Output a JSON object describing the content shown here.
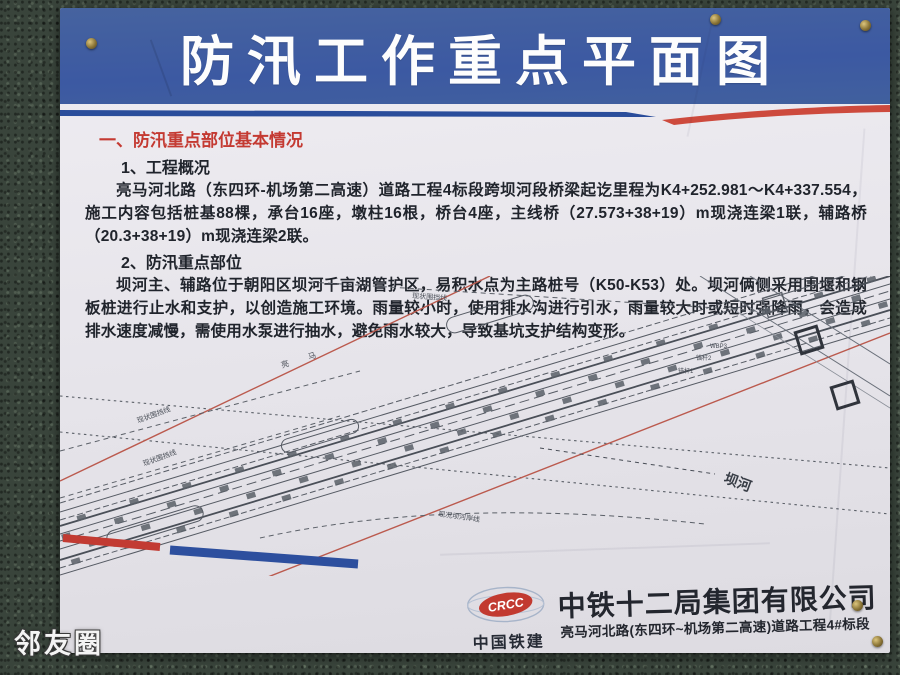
{
  "watermark": "邻友圈",
  "poster": {
    "title": "防汛工作重点平面图",
    "section": {
      "heading": "一、防汛重点部位基本情况",
      "sub1": "1、工程概况",
      "para1": "亮马河北路（东四环-机场第二高速）道路工程4标段跨坝河段桥梁起讫里程为K4+252.981～K4+337.554，施工内容包括桩基88棵，承台16座，墩柱16根，桥台4座，主线桥（27.573+38+19）m现浇连梁1联，辅路桥（20.3+38+19）m现浇连梁2联。",
      "sub2": "2、防汛重点部位",
      "para2": "坝河主、辅路位于朝阳区坝河千亩湖管护区，易积水点为主路桩号（K50-K53）处。坝河俩侧采用围堰和钢板桩进行止水和支护，以创造施工环境。雨量较小时，使用排水沟进行引水，雨量较大时或短时强降雨，会造成排水速度减慢，需使用水泵进行抽水，避免雨水较大，导致基坑支护结构变形。"
    },
    "diagram": {
      "river": "坝河",
      "fence_top": "现状围挡线",
      "fence_left1": "现状围挡线",
      "fence_left2": "现状围挡线",
      "bank_bottom": "现况坝河岸线",
      "road_name": "亮 马",
      "anchor1": "锚杆1",
      "anchor2": "锚杆2",
      "anchor3": "WBP3"
    },
    "footer": {
      "logo_text": "CRCC",
      "logo_caption": "中国铁建",
      "company": "中铁十二局集团有限公司",
      "project": "亮马河北路(东四环~机场第二高速)道路工程4#标段"
    },
    "colors": {
      "banner_blue": "#3f5ea6",
      "heading_red": "#c43a32",
      "stripe_red": "#cd4a3d",
      "stripe_blue": "#2a4d9b",
      "logo_red": "#c23a30"
    }
  }
}
